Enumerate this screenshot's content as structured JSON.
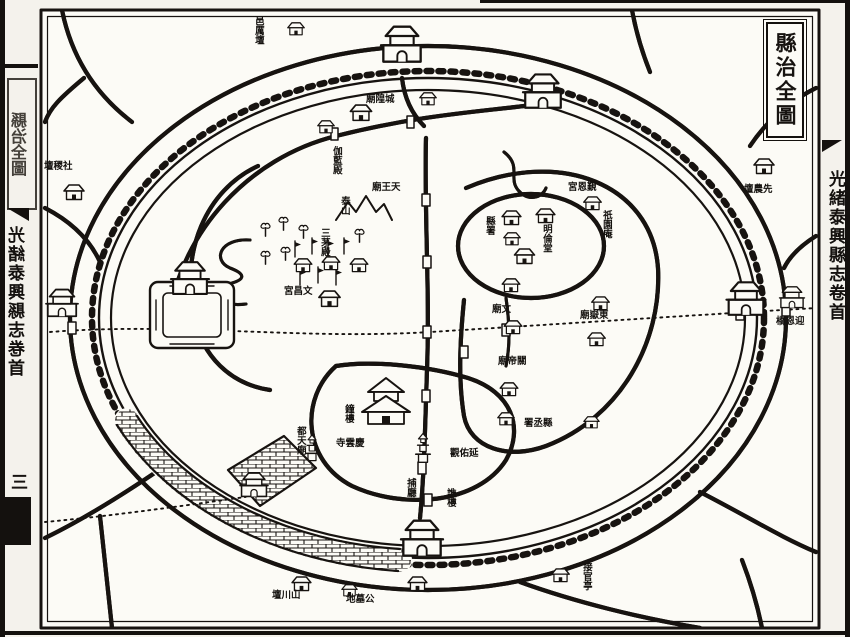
{
  "page": {
    "kind": "woodblock county-seat map page",
    "title_box": "縣治全圖",
    "left_margin": {
      "box_title": "縣治全圖",
      "spine": "光緒泰興縣志卷首",
      "page_number": "三"
    },
    "right_margin": {
      "spine": "光緒泰興縣志卷首"
    },
    "colors": {
      "ink": "#171310",
      "paper": "#f4f2ec",
      "map_paper": "#fcfbf6"
    }
  },
  "map": {
    "labels": [
      {
        "name": "yi-li-tan",
        "text": "邑厲壇",
        "display": "邑厲壇",
        "orient": "v"
      },
      {
        "name": "she-ji-tan",
        "text": "社稷壇",
        "display": "壇稷社",
        "orient": "h"
      },
      {
        "name": "xian-nong-tan",
        "text": "先農壇",
        "display": "壇農先",
        "orient": "h"
      },
      {
        "name": "shan-chuan-tan",
        "text": "山川壇",
        "display": "壇川山",
        "orient": "h"
      },
      {
        "name": "gong-mu-di",
        "text": "公墓地",
        "display": "地墓公",
        "orient": "h"
      },
      {
        "name": "jie-guan-ting",
        "text": "接官亭",
        "display": "接官亭",
        "orient": "v"
      },
      {
        "name": "ying-en-qiao",
        "text": "迎恩橋",
        "display": "橋恩迎",
        "orient": "h"
      },
      {
        "name": "cheng-huang-miao",
        "text": "城隍廟",
        "display": "廟隍城",
        "orient": "h"
      },
      {
        "name": "qie-lan-dian",
        "text": "伽藍殿",
        "display": "伽藍殿",
        "orient": "v"
      },
      {
        "name": "tian-wang-miao",
        "text": "天王廟",
        "display": "廟王天",
        "orient": "h"
      },
      {
        "name": "tai-shan",
        "text": "泰山",
        "display": "泰山",
        "orient": "v"
      },
      {
        "name": "san-mao-dian",
        "text": "三茅殿",
        "display": "三茅殿",
        "orient": "v"
      },
      {
        "name": "wen-chang-gong",
        "text": "文昌宮",
        "display": "宮昌文",
        "orient": "h"
      },
      {
        "name": "wen-miao",
        "text": "文廟",
        "display": "廟文",
        "orient": "h"
      },
      {
        "name": "ming-lun-tang",
        "text": "明倫堂",
        "display": "明倫堂",
        "orient": "v"
      },
      {
        "name": "xian-shu",
        "text": "縣署",
        "display": "縣署",
        "orient": "v"
      },
      {
        "name": "jin-en-gong",
        "text": "覲恩宮",
        "display": "宮恩覲",
        "orient": "h"
      },
      {
        "name": "qi-yuan-an",
        "text": "祇園庵",
        "display": "祇園庵",
        "orient": "v"
      },
      {
        "name": "guan-di-miao",
        "text": "關帝廟",
        "display": "廟帝關",
        "orient": "h"
      },
      {
        "name": "yan-you-guan",
        "text": "延佑觀",
        "display": "觀佑延",
        "orient": "h"
      },
      {
        "name": "qing-yun-si",
        "text": "慶雲寺",
        "display": "寺雲慶",
        "orient": "h"
      },
      {
        "name": "xian-cheng-shu",
        "text": "縣丞署",
        "display": "署丞縣",
        "orient": "h"
      },
      {
        "name": "du-tian-miao",
        "text": "都天廟",
        "display": "都天廟",
        "orient": "v"
      },
      {
        "name": "qiao-lou",
        "text": "譙樓",
        "display": "譙樓",
        "orient": "v"
      },
      {
        "name": "bu-ting",
        "text": "捕廳",
        "display": "捕廳",
        "orient": "v"
      },
      {
        "name": "zhong-lou",
        "text": "鐘樓",
        "display": "鐘樓",
        "orient": "v"
      },
      {
        "name": "dong-yue-miao",
        "text": "東嶽廟",
        "display": "廟嶽東",
        "orient": "h"
      }
    ]
  }
}
